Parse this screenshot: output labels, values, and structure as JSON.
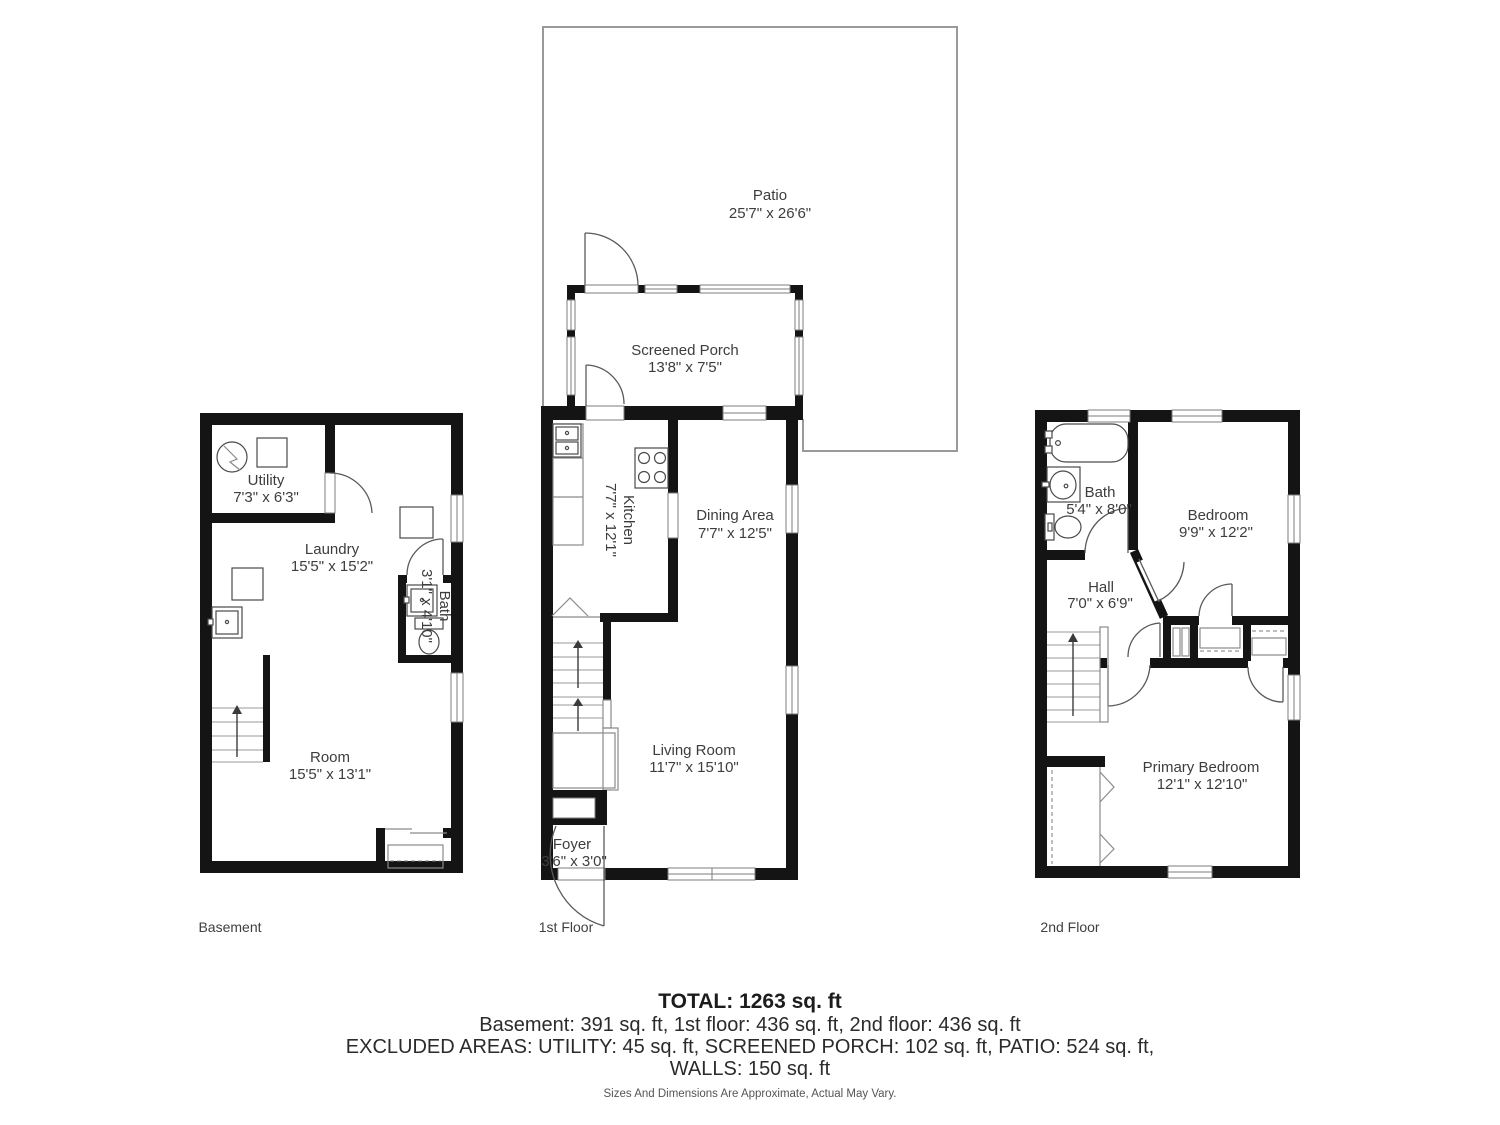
{
  "patio": {
    "name": "Patio",
    "dims": "25'7\" x 26'6\""
  },
  "porch": {
    "name": "Screened Porch",
    "dims": "13'8\" x 7'5\""
  },
  "basement": {
    "floor_label": "Basement",
    "utility": {
      "name": "Utility",
      "dims": "7'3\" x 6'3\""
    },
    "laundry": {
      "name": "Laundry",
      "dims": "15'5\" x 15'2\""
    },
    "bath": {
      "name": "Bath",
      "dims": "3'1\" x 4'10\""
    },
    "room": {
      "name": "Room",
      "dims": "15'5\" x 13'1\""
    }
  },
  "first_floor": {
    "floor_label": "1st Floor",
    "kitchen": {
      "name": "Kitchen",
      "dims": "7'7\" x 12'1\""
    },
    "dining": {
      "name": "Dining Area",
      "dims": "7'7\" x 12'5\""
    },
    "living": {
      "name": "Living Room",
      "dims": "11'7\" x 15'10\""
    },
    "foyer": {
      "name": "Foyer",
      "dims": "3'6\" x 3'0\""
    }
  },
  "second_floor": {
    "floor_label": "2nd Floor",
    "bath": {
      "name": "Bath",
      "dims": "5'4\" x 8'0\""
    },
    "bedroom": {
      "name": "Bedroom",
      "dims": "9'9\" x 12'2\""
    },
    "hall": {
      "name": "Hall",
      "dims": "7'0\" x 6'9\""
    },
    "primary_bedroom": {
      "name": "Primary Bedroom",
      "dims": "12'1\" x 12'10\""
    }
  },
  "summary": {
    "total": "TOTAL: 1263 sq. ft",
    "floor_areas": "Basement: 391 sq. ft, 1st floor: 436 sq. ft, 2nd floor: 436 sq. ft",
    "excluded": "EXCLUDED AREAS: UTILITY: 45 sq. ft, SCREENED PORCH: 102 sq. ft, PATIO: 524 sq. ft,",
    "walls": "WALLS: 150 sq. ft",
    "disclaimer": "Sizes And Dimensions Are Approximate, Actual May Vary."
  },
  "colors": {
    "wall": "#141414",
    "label_text": "#3d3d3d",
    "thin_line": "#8a8a8a",
    "patio_outline": "#9a9a9a"
  }
}
